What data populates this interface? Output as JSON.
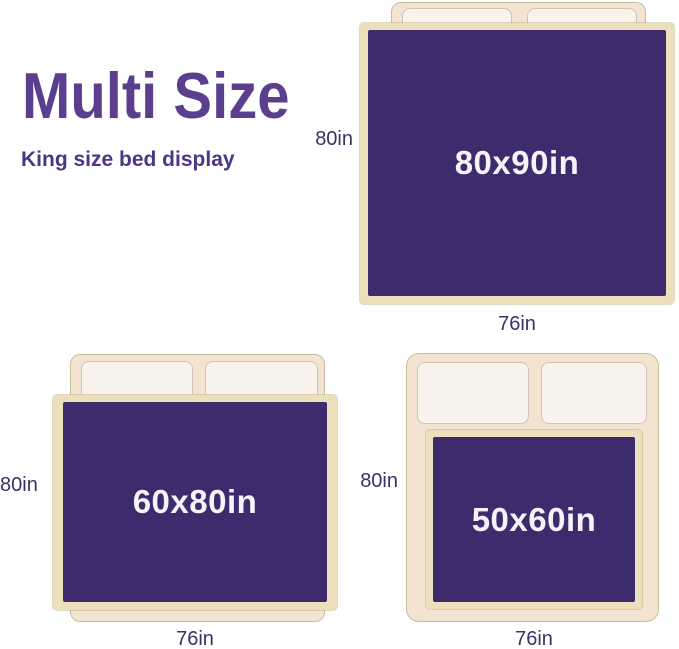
{
  "header": {
    "title": "Multi Size",
    "subtitle": "King size bed display"
  },
  "colors": {
    "title_purple": "#5b3f8e",
    "subtitle_purple": "#4d3585",
    "blanket_purple": "#3e2b6d",
    "blanket_trim": "#ecdfbc",
    "blanket_text": "#f5f2f8",
    "bed_frame": "#f2e4d0",
    "bed_frame_border": "#c9bb9e",
    "pillow": "#f9f3ee",
    "pillow_border": "#cfc3b3",
    "dimension_label": "#3c3163"
  },
  "beds": [
    {
      "name": "king-bed-with-80x90-blanket",
      "blanket_size": "80x90in",
      "side_dimension": "80in",
      "bottom_dimension": "76in"
    },
    {
      "name": "king-bed-with-60x80-blanket",
      "blanket_size": "60x80in",
      "side_dimension": "80in",
      "bottom_dimension": "76in"
    },
    {
      "name": "king-bed-with-50x60-blanket",
      "blanket_size": "50x60in",
      "side_dimension": "80in",
      "bottom_dimension": "76in"
    }
  ]
}
